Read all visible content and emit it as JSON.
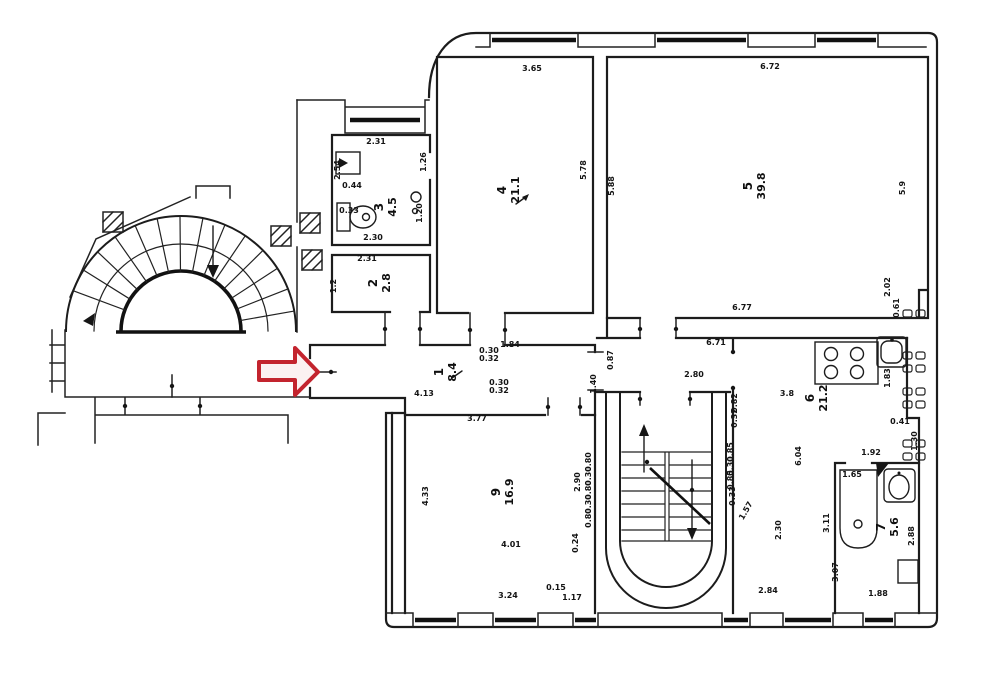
{
  "meta": {
    "document_type": "scanned apartment floor plan (BTI technical drawing)",
    "spiral_staircase": "semicircular winder stair, top-left",
    "main_staircase": "double-flight stair with half-turn, bottom-center",
    "annotation_note": "red arrow marks corridor entrance"
  },
  "palette": {
    "ink": "#1c1c1c",
    "paper": "#ffffff",
    "annotation_red": "#c3242e",
    "arrow_fill": "#fbf1f1"
  },
  "annotation": {
    "type": "arrow",
    "direction": "right",
    "target": "corridor-1-entrance"
  },
  "rooms": [
    {
      "number": "1",
      "area": "8.4",
      "x": 443,
      "y": 372,
      "s": 8.5
    },
    {
      "number": "2",
      "area": "2.8",
      "x": 377,
      "y": 283
    },
    {
      "number": "3",
      "area": "4.5",
      "x": 383,
      "y": 207
    },
    {
      "number": "4",
      "area": "21.1",
      "x": 506,
      "y": 190
    },
    {
      "number": "5",
      "area": "39.8",
      "x": 752,
      "y": 186
    },
    {
      "number": "6",
      "area": "21.2",
      "x": 814,
      "y": 398
    },
    {
      "number": "7",
      "area": "5.6",
      "x": 885,
      "y": 527
    },
    {
      "number": "9",
      "area": "16.9",
      "x": 500,
      "y": 492
    }
  ],
  "dimension_labels": [
    {
      "t": "3.65",
      "x": 532,
      "y": 71,
      "r": 0
    },
    {
      "t": "6.72",
      "x": 770,
      "y": 69,
      "r": 0
    },
    {
      "t": "5.78",
      "x": 586,
      "y": 170,
      "r": -90
    },
    {
      "t": "5.88",
      "x": 614,
      "y": 186,
      "r": -90
    },
    {
      "t": "5.9",
      "x": 905,
      "y": 188,
      "r": -90
    },
    {
      "t": "6.77",
      "x": 742,
      "y": 310,
      "r": 0
    },
    {
      "t": "2.02",
      "x": 890,
      "y": 287,
      "r": -90,
      "s": 7.5
    },
    {
      "t": "0.61",
      "x": 899,
      "y": 308,
      "r": -90,
      "s": 7.5
    },
    {
      "t": "2.31",
      "x": 376,
      "y": 144,
      "r": 0
    },
    {
      "t": "2.54",
      "x": 340,
      "y": 170,
      "r": -90,
      "s": 7.5
    },
    {
      "t": "0.44",
      "x": 352,
      "y": 188,
      "r": 0,
      "s": 7.5
    },
    {
      "t": "0.33",
      "x": 349,
      "y": 213,
      "r": 0,
      "s": 7
    },
    {
      "t": "1.26",
      "x": 426,
      "y": 162,
      "r": -90,
      "s": 7.5
    },
    {
      "t": "1.20",
      "x": 422,
      "y": 213,
      "r": -90,
      "s": 7.5
    },
    {
      "t": "2.30",
      "x": 373,
      "y": 240,
      "r": 0
    },
    {
      "t": "2.31",
      "x": 367,
      "y": 261,
      "r": 0
    },
    {
      "t": "1.2",
      "x": 336,
      "y": 286,
      "r": -90,
      "s": 7.5
    },
    {
      "t": "1.84",
      "x": 510,
      "y": 347,
      "r": 0
    },
    {
      "t": "0.30",
      "x": 489,
      "y": 353,
      "r": 0,
      "s": 6.5
    },
    {
      "t": "0.32",
      "x": 489,
      "y": 361,
      "r": 0,
      "s": 6.5
    },
    {
      "t": "0.30",
      "x": 499,
      "y": 385,
      "r": 0,
      "s": 6.5
    },
    {
      "t": "0.32",
      "x": 499,
      "y": 393,
      "r": 0,
      "s": 6.5
    },
    {
      "t": "4.13",
      "x": 424,
      "y": 396,
      "r": 0
    },
    {
      "t": "1.40",
      "x": 596,
      "y": 384,
      "r": -90,
      "s": 7.5
    },
    {
      "t": "0.87",
      "x": 613,
      "y": 360,
      "r": -90,
      "s": 7.5
    },
    {
      "t": "6.71",
      "x": 716,
      "y": 345,
      "r": 0
    },
    {
      "t": "2.80",
      "x": 694,
      "y": 377,
      "r": 0
    },
    {
      "t": "0.82",
      "x": 737,
      "y": 403,
      "r": -90,
      "s": 7
    },
    {
      "t": "0.32",
      "x": 737,
      "y": 418,
      "r": -90,
      "s": 7
    },
    {
      "t": "3.8",
      "x": 787,
      "y": 396,
      "r": 0
    },
    {
      "t": "6.04",
      "x": 801,
      "y": 456,
      "r": -90
    },
    {
      "t": "1.83",
      "x": 890,
      "y": 378,
      "r": -90,
      "s": 7.5
    },
    {
      "t": "0.41",
      "x": 900,
      "y": 424,
      "r": 0,
      "s": 7
    },
    {
      "t": "1.30",
      "x": 917,
      "y": 441,
      "r": -90,
      "s": 7.5
    },
    {
      "t": "1.92",
      "x": 871,
      "y": 455,
      "r": 0,
      "s": 7.5
    },
    {
      "t": "3.77",
      "x": 477,
      "y": 421,
      "r": 0
    },
    {
      "t": "4.33",
      "x": 428,
      "y": 496,
      "r": -90
    },
    {
      "t": "2.90",
      "x": 580,
      "y": 482,
      "r": -90,
      "s": 7.5
    },
    {
      "t": "4.01",
      "x": 511,
      "y": 547,
      "r": 0,
      "s": 7.5
    },
    {
      "t": "0.24",
      "x": 578,
      "y": 543,
      "r": -90,
      "s": 7.5
    },
    {
      "t": "3.24",
      "x": 508,
      "y": 598,
      "r": 0
    },
    {
      "t": "0.15",
      "x": 556,
      "y": 590,
      "r": 0,
      "s": 6.5
    },
    {
      "t": "1.17",
      "x": 572,
      "y": 600,
      "r": 0,
      "s": 6.5
    },
    {
      "t": "0.80",
      "x": 591,
      "y": 462,
      "r": -90,
      "s": 6.5
    },
    {
      "t": "0.30",
      "x": 591,
      "y": 476,
      "r": -90,
      "s": 6.5
    },
    {
      "t": "0.80",
      "x": 591,
      "y": 490,
      "r": -90,
      "s": 6.5
    },
    {
      "t": "0.30",
      "x": 591,
      "y": 504,
      "r": -90,
      "s": 6.5
    },
    {
      "t": "0.80",
      "x": 591,
      "y": 518,
      "r": -90,
      "s": 6.5
    },
    {
      "t": "0.85",
      "x": 733,
      "y": 452,
      "r": -90,
      "s": 6.5
    },
    {
      "t": "0.30",
      "x": 733,
      "y": 466,
      "r": -90,
      "s": 6.5
    },
    {
      "t": "0.85",
      "x": 733,
      "y": 480,
      "r": -90,
      "s": 6.5
    },
    {
      "t": "0.33",
      "x": 735,
      "y": 496,
      "r": -90,
      "s": 6.5
    },
    {
      "t": "1.57",
      "x": 748,
      "y": 512,
      "r": -60,
      "s": 7
    },
    {
      "t": "2.30",
      "x": 781,
      "y": 530,
      "r": -90
    },
    {
      "t": "2.84",
      "x": 768,
      "y": 593,
      "r": 0
    },
    {
      "t": "3.11",
      "x": 829,
      "y": 523,
      "r": -90,
      "s": 7.5
    },
    {
      "t": "3.07",
      "x": 838,
      "y": 572,
      "r": -90,
      "s": 7.5
    },
    {
      "t": "1.65",
      "x": 852,
      "y": 477,
      "r": 0,
      "s": 7
    },
    {
      "t": "2.88",
      "x": 914,
      "y": 536,
      "r": -90,
      "s": 7.5
    },
    {
      "t": "1.88",
      "x": 878,
      "y": 596,
      "r": 0
    }
  ]
}
